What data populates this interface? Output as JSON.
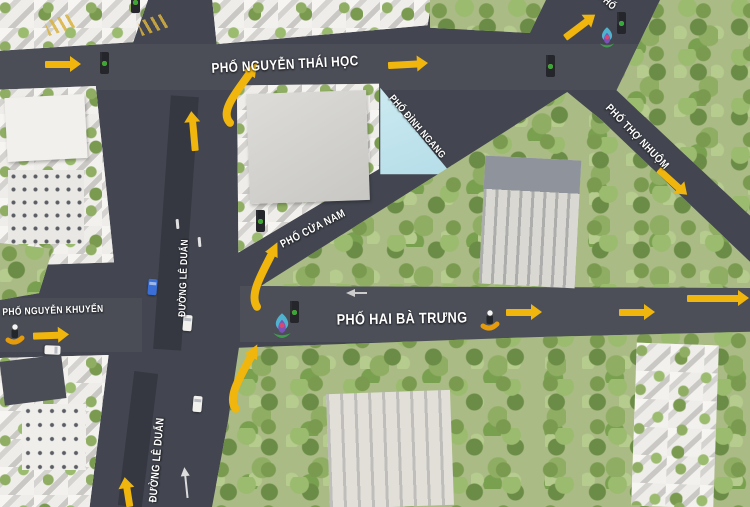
{
  "map": {
    "title": "Hanoi intersection traffic-flow map",
    "colors": {
      "road": "#434650",
      "arrow_yellow": "#f0b60e",
      "tree_green": "#7a9a50",
      "building_light": "#e7e5df",
      "light_blue_block": "#bfe3ea",
      "label_white": "#ffffff",
      "signal_red": "#e23c2e",
      "signal_yellow": "#f3c019",
      "signal_green": "#35a83a"
    },
    "streets": [
      {
        "id": "nguyen-thai-hoc",
        "label": "PHỐ NGUYỄN THÁI HỌC"
      },
      {
        "id": "hai-ba-trung",
        "label": "PHỐ HAI BÀ TRƯNG"
      },
      {
        "id": "nguyen-khuyen",
        "label": "PHỐ NGUYỄN KHUYẾN"
      },
      {
        "id": "le-duan-upper",
        "label": "ĐƯỜNG LÊ DUẨN"
      },
      {
        "id": "le-duan-lower",
        "label": "ĐƯỜNG LÊ DUẨN"
      },
      {
        "id": "cua-nam",
        "label": "PHỐ CỬA NAM"
      },
      {
        "id": "dinh-ngang",
        "label": "PHỐ ĐÌNH NGANG"
      },
      {
        "id": "tho-nhuom",
        "label": "PHỐ THỢ NHUỘM"
      },
      {
        "id": "partial-top-right",
        "label": "PHỐ"
      }
    ],
    "flow_arrows": [
      {
        "id": "flow-nth-west",
        "kind": "straight",
        "direction": "right",
        "x": 63,
        "y": 64,
        "angle": 0,
        "len": 36
      },
      {
        "id": "flow-nth-mid",
        "kind": "straight",
        "direction": "right",
        "x": 408,
        "y": 64,
        "angle": -3,
        "len": 40
      },
      {
        "id": "flow-top-right",
        "kind": "straight",
        "direction": "up-right",
        "x": 580,
        "y": 26,
        "angle": -37,
        "len": 38
      },
      {
        "id": "flow-le-duan-north",
        "kind": "straight",
        "direction": "up",
        "x": 193,
        "y": 131,
        "angle": -95,
        "len": 40
      },
      {
        "id": "flow-turn-le-duan-to-nth",
        "kind": "curved",
        "direction": "up-right",
        "x": 218,
        "y": 66,
        "w": 40,
        "h": 58
      },
      {
        "id": "flow-turn-le-duan-to-cua-nam",
        "kind": "curved",
        "direction": "up-right",
        "x": 248,
        "y": 246,
        "w": 30,
        "h": 62
      },
      {
        "id": "flow-turn-le-duan-mid",
        "kind": "curved",
        "direction": "up-right",
        "x": 226,
        "y": 348,
        "w": 32,
        "h": 62
      },
      {
        "id": "flow-hbt-1",
        "kind": "straight",
        "direction": "right",
        "x": 524,
        "y": 312,
        "angle": 0,
        "len": 36
      },
      {
        "id": "flow-hbt-2",
        "kind": "straight",
        "direction": "right",
        "x": 637,
        "y": 312,
        "angle": 0,
        "len": 36
      },
      {
        "id": "flow-hbt-3",
        "kind": "straight",
        "direction": "right",
        "x": 718,
        "y": 298,
        "angle": 0,
        "len": 62
      },
      {
        "id": "flow-nguyen-khuyen",
        "kind": "straight",
        "direction": "right",
        "x": 51,
        "y": 335,
        "angle": -2,
        "len": 36
      },
      {
        "id": "flow-le-duan-south",
        "kind": "straight",
        "direction": "up",
        "x": 127,
        "y": 492,
        "angle": -99,
        "len": 30
      },
      {
        "id": "flow-tho-nhuom",
        "kind": "straight",
        "direction": "down-right",
        "x": 673,
        "y": 182,
        "angle": 42,
        "len": 38
      }
    ],
    "traffic_lights": [
      {
        "id": "tl-nth-west",
        "x": 100,
        "y": 52
      },
      {
        "id": "tl-top-edge",
        "x": 131,
        "y": -9
      },
      {
        "id": "tl-nth-mid",
        "x": 546,
        "y": 55
      },
      {
        "id": "tl-top-right",
        "x": 617,
        "y": 12
      },
      {
        "id": "tl-cua-nam",
        "x": 256,
        "y": 210
      },
      {
        "id": "tl-hbt",
        "x": 290,
        "y": 301
      }
    ],
    "decorations": [
      {
        "id": "flower-pillar-top-right",
        "x": 598,
        "y": 26,
        "w": 18,
        "h": 26
      },
      {
        "id": "flower-pillar-hbt",
        "x": 271,
        "y": 312,
        "w": 22,
        "h": 31
      }
    ],
    "vehicles": [
      {
        "id": "moto-nguyen-khuyen",
        "type": "motorbike",
        "x": 4,
        "y": 322
      },
      {
        "id": "moto-hbt",
        "type": "motorbike",
        "x": 479,
        "y": 308
      },
      {
        "id": "car-1",
        "type": "car",
        "body": "#f2f1ee",
        "glass": "#b9bcc2",
        "x": 183,
        "y": 315,
        "rot": 5
      },
      {
        "id": "car-2",
        "type": "car",
        "body": "#f2f1ee",
        "glass": "#b9bcc2",
        "x": 193,
        "y": 396,
        "rot": 5
      },
      {
        "id": "car-3",
        "type": "car",
        "body": "#f2f1ee",
        "glass": "#b9bcc2",
        "x": 48,
        "y": 342,
        "rot": 92
      },
      {
        "id": "car-4",
        "type": "car",
        "body": "#3a6fd8",
        "glass": "#9db7e8",
        "x": 148,
        "y": 279,
        "rot": 5
      }
    ],
    "road_markings": [
      {
        "id": "lane-dash-1",
        "kind": "dash",
        "x": 176,
        "y": 219,
        "rot": -5
      },
      {
        "id": "lane-dash-2",
        "kind": "dash",
        "x": 198,
        "y": 237,
        "rot": -5
      },
      {
        "id": "lane-arrow-le-duan",
        "kind": "up-arrow",
        "x": 180,
        "y": 466,
        "rot": -6
      },
      {
        "id": "lane-arrow-hbt",
        "kind": "left-arrow",
        "x": 345,
        "y": 288,
        "rot": 0
      },
      {
        "id": "crosswalk-1",
        "kind": "crosswalk",
        "x": 46,
        "y": 17,
        "rot": -18
      },
      {
        "id": "crosswalk-2",
        "kind": "crosswalk",
        "x": 139,
        "y": 17,
        "rot": -18
      }
    ]
  }
}
